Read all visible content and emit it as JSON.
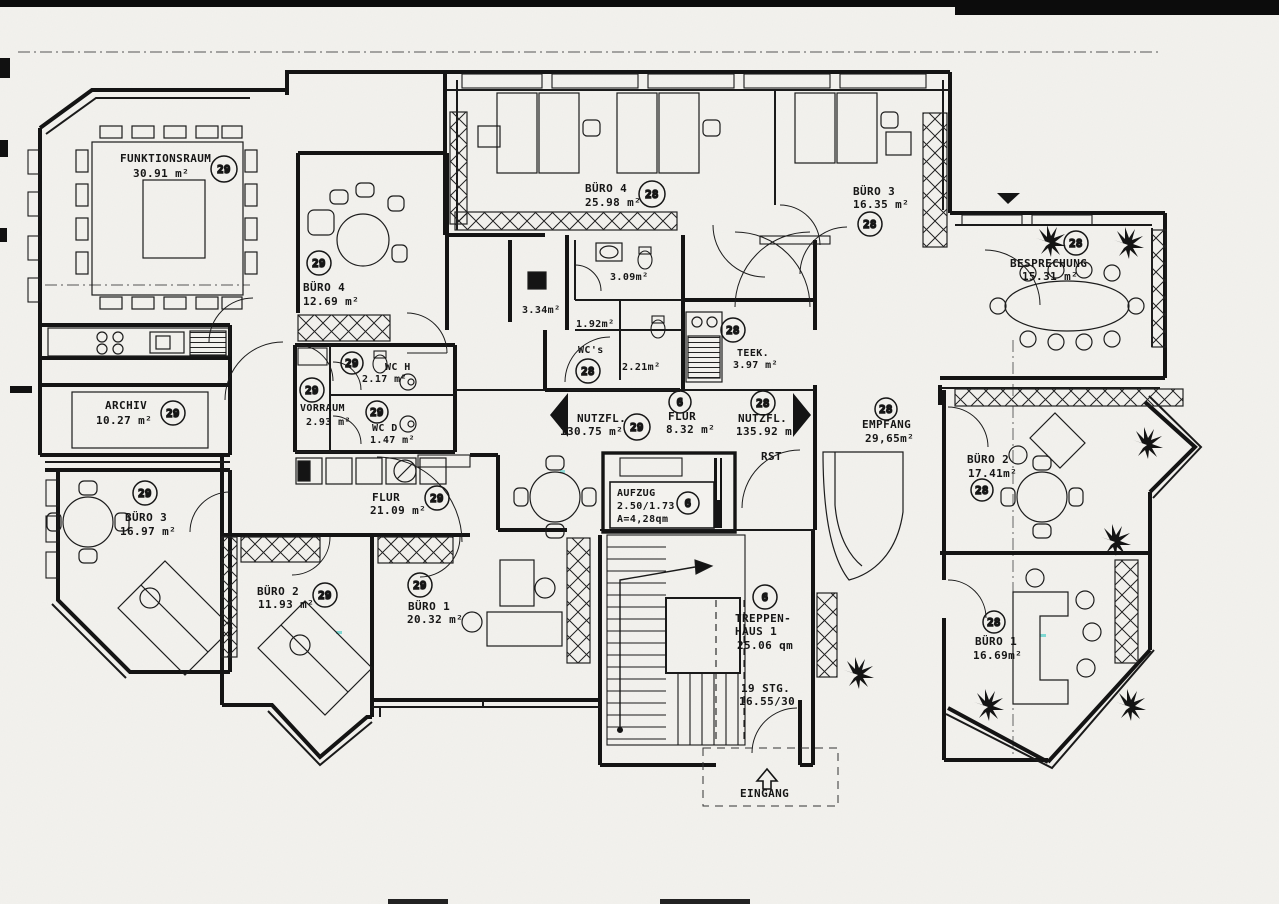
{
  "drawing": {
    "background": "#f3f2ee",
    "ink": "#161616"
  },
  "rooms": [
    {
      "name": "FUNKTIONSRAUM",
      "area": "30.91 m²",
      "badge": "29"
    },
    {
      "name": "BÜRO 4",
      "area": "12.69 m²",
      "badge": "29"
    },
    {
      "name": "BÜRO 4",
      "area": "25.98 m²",
      "badge": "28"
    },
    {
      "name": "BÜRO 3",
      "area": "16.35 m²",
      "badge": "28"
    },
    {
      "name": "BESPRECHUNG",
      "area": "15.31 m²",
      "badge": "28"
    },
    {
      "name": "ARCHIV",
      "area": "10.27 m²",
      "badge": "29"
    },
    {
      "name": "VORRAUM",
      "area": "2.93 m²",
      "badge": "29"
    },
    {
      "name": "WC H",
      "area": "2.17 m²",
      "badge": "29"
    },
    {
      "name": "WC D",
      "area": "1.47 m²",
      "badge": "29"
    },
    {
      "name": "WC's",
      "area": "",
      "badge": "28"
    },
    {
      "name": "TEEK.",
      "area": "3.97 m²",
      "badge": "28"
    },
    {
      "name": "NUTZFL.",
      "area": "130.75 m²",
      "badge": "29"
    },
    {
      "name": "FLUR",
      "area": "8.32 m²",
      "badge": "6"
    },
    {
      "name": "NUTZFL.",
      "area": "135.92 m²",
      "badge": "28"
    },
    {
      "name": "EMPFANG",
      "area": "29,65m²",
      "badge": "28"
    },
    {
      "name": "BÜRO 2",
      "area": "17.41m²",
      "badge": "28"
    },
    {
      "name": "BÜRO 1",
      "area": "16.69m²",
      "badge": "28"
    },
    {
      "name": "BÜRO 3",
      "area": "16.97 m²",
      "badge": "29"
    },
    {
      "name": "FLUR",
      "area": "21.09 m²",
      "badge": "29"
    },
    {
      "name": "BÜRO 2",
      "area": "11.93 m²",
      "badge": "29"
    },
    {
      "name": "BÜRO 1",
      "area": "20.32 m²",
      "badge": "29"
    }
  ],
  "elevator": {
    "name": "AUFZUG",
    "dim": "2.50/1.73",
    "area": "A=4,28qm",
    "badge": "6"
  },
  "stairs": {
    "line1": "TREPPEN-",
    "line2": "HAUS 1",
    "area": "25.06 qm",
    "badge": "6",
    "steps": "19 STG.",
    "step_dim": "16.55/30"
  },
  "wc_areas": {
    "a334": "3.34m²",
    "a309": "3.09m²",
    "a192": "1.92m²",
    "a221": "2.21m²"
  },
  "annotations": {
    "rst": "RST",
    "eingang": "EINGANG"
  }
}
